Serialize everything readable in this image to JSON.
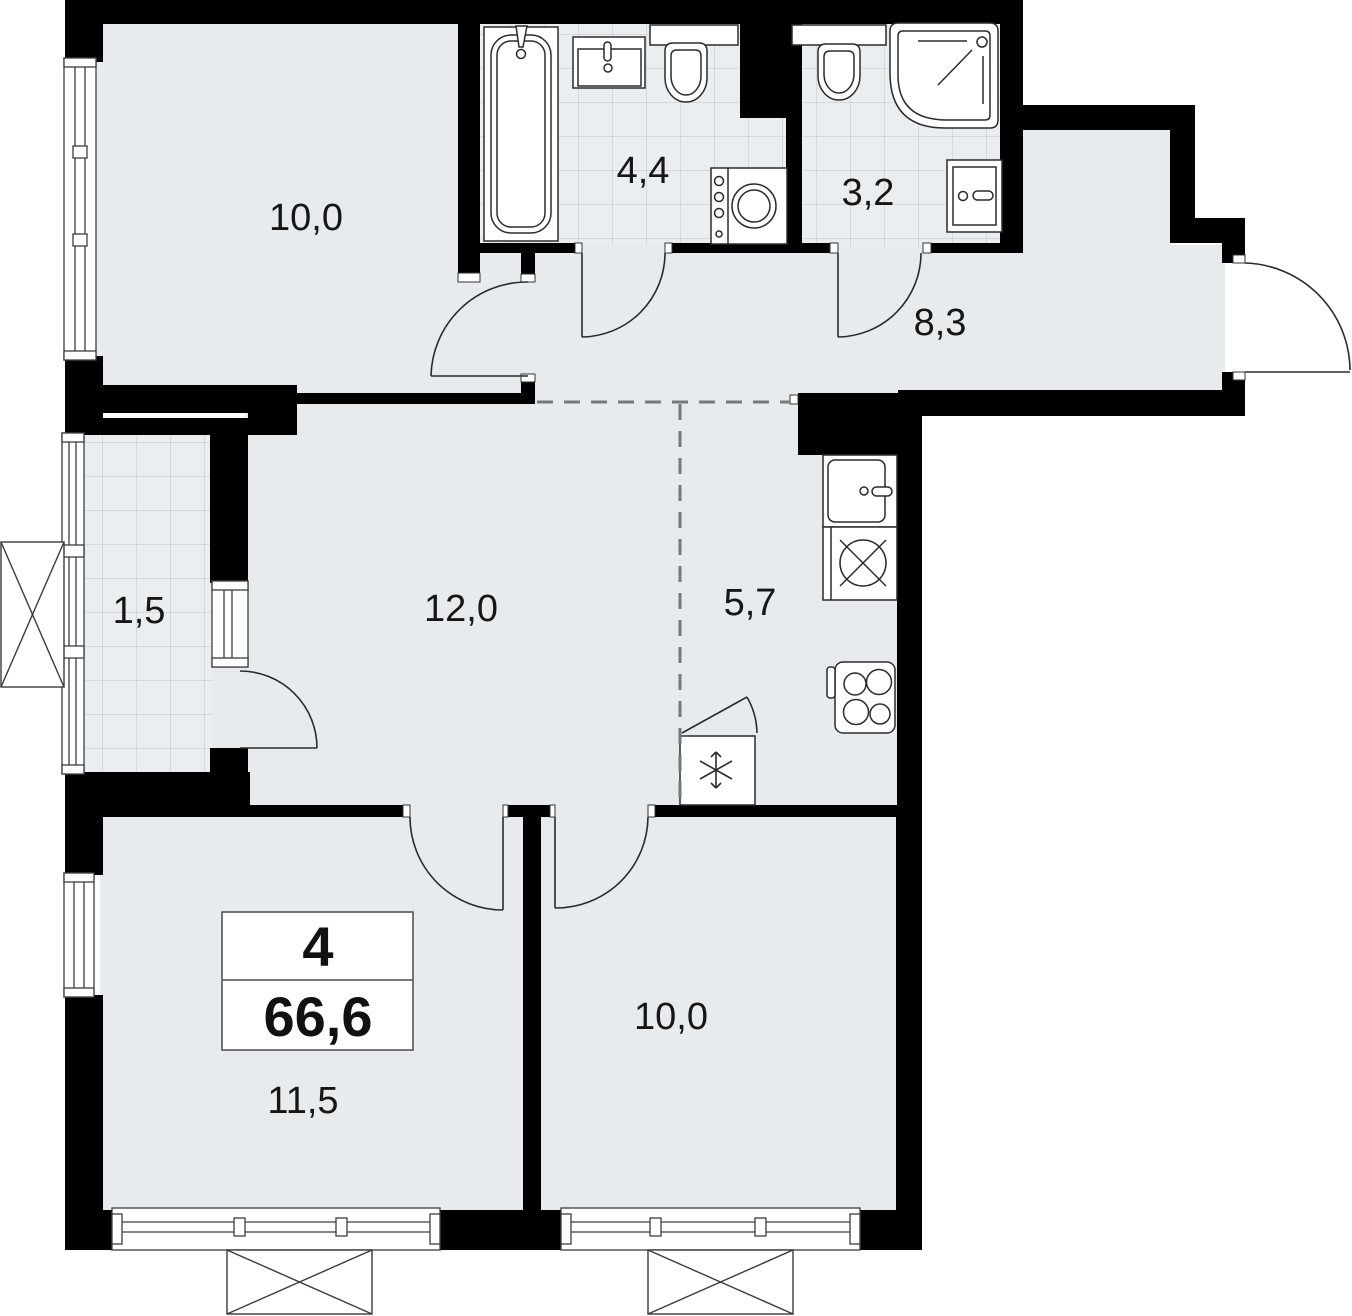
{
  "floorplan": {
    "summary": {
      "rooms_count": "4",
      "total_area": "66,6"
    },
    "rooms": [
      {
        "key": "bedroom-top",
        "area": "10,0"
      },
      {
        "key": "bathroom",
        "area": "4,4"
      },
      {
        "key": "toilet-shower",
        "area": "3,2"
      },
      {
        "key": "hallway",
        "area": "8,3"
      },
      {
        "key": "balcony",
        "area": "1,5"
      },
      {
        "key": "living-room",
        "area": "12,0"
      },
      {
        "key": "kitchen",
        "area": "5,7"
      },
      {
        "key": "bedroom-left",
        "area": "11,5"
      },
      {
        "key": "bedroom-right",
        "area": "10,0"
      }
    ],
    "icons": [
      "bathtub-icon",
      "washbasin-icon",
      "toilet-icon",
      "washing-machine-icon",
      "shower-icon",
      "kitchen-sink-icon",
      "dishwasher-icon",
      "stove-icon",
      "fridge-icon",
      "snowflake-icon",
      "ac-unit-icon",
      "door-arc-icon",
      "window-icon"
    ],
    "colors": {
      "wall": "#000000",
      "room_fill": "#e8ebee",
      "tile_fill": "#ebeef0",
      "tile_grid": "#bfc4c7",
      "line": "#2b2b2b",
      "dash": "#76797c",
      "background": "#ffffff"
    }
  }
}
